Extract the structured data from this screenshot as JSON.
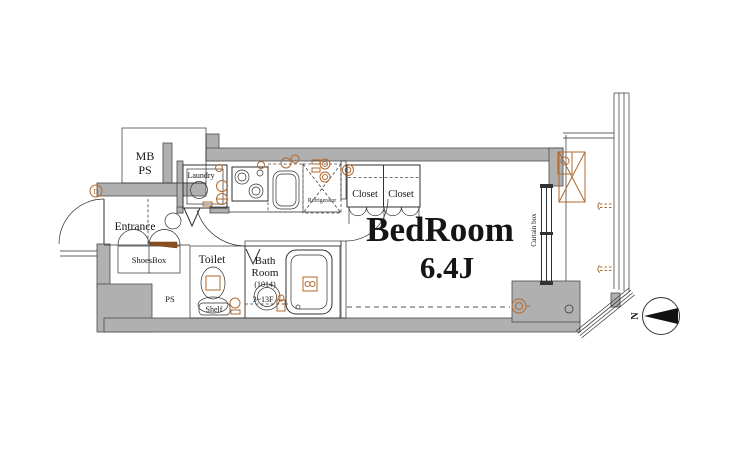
{
  "colors": {
    "wall_fill": "#b0b0b0",
    "line": "#2f2f2f",
    "accent_orange": "#b2692e",
    "text": "#151515",
    "background": "#ffffff"
  },
  "labels": {
    "mb": "MB",
    "ps_top": "PS",
    "entrance": "Entrance",
    "door_marker": "D",
    "shoesbox": "ShoesBox",
    "laundry": "Laundry",
    "refrigerator": "Refrigerator",
    "closet_left": "Closet",
    "closet_right": "Closet",
    "bedroom_name": "BedRoom",
    "bedroom_size": "6.4J",
    "curtain_box": "Curtain box",
    "toilet": "Toilet",
    "shelf": "Shelf",
    "bath_line1": "Bath",
    "bath_line2": "Room",
    "bath_size": "(1014)",
    "bath_floors": "3~13F",
    "ps_bottom": "PS",
    "compass_north": "N"
  }
}
